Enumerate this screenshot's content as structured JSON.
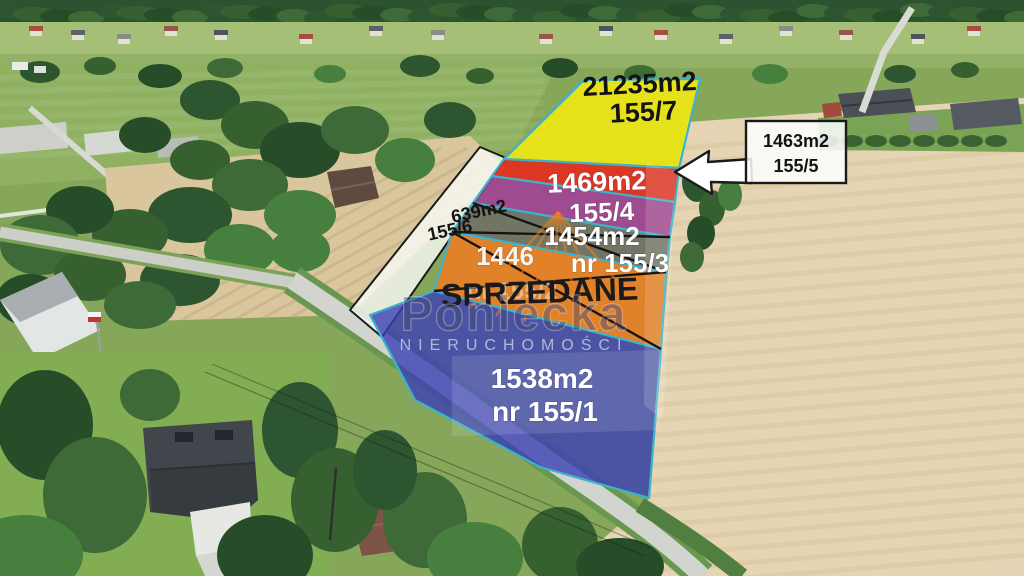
{
  "watermark": {
    "brand": "Poniecka",
    "subtitle": "NIERUCHOMOŚCI"
  },
  "sold_label": "SPRZEDANE",
  "parcels": {
    "p7": {
      "area": "21235m2",
      "number": "155/7"
    },
    "p5": {
      "area": "1463m2",
      "number": "155/5"
    },
    "p4": {
      "area": "1469m2",
      "number": "155/4"
    },
    "p3": {
      "area": "1454m2",
      "number": "nr 155/3"
    },
    "p2": {
      "area": "1446",
      "number": "nr 155/2"
    },
    "p1": {
      "area": "1538m2",
      "number": "nr 155/1"
    },
    "p6": {
      "area": "639m2",
      "number": "155/6"
    }
  },
  "colors": {
    "p7": "#f3ea10",
    "p5": "#e7281b",
    "p4": "#a23d97",
    "p3": "#6d6a66",
    "p2": "#ef7d22",
    "p1": "#3b40b4",
    "p6": "#f8f8f3",
    "boundary": "#3db2cc",
    "cross": "#151515",
    "sold_text": "#1a1a1a"
  }
}
